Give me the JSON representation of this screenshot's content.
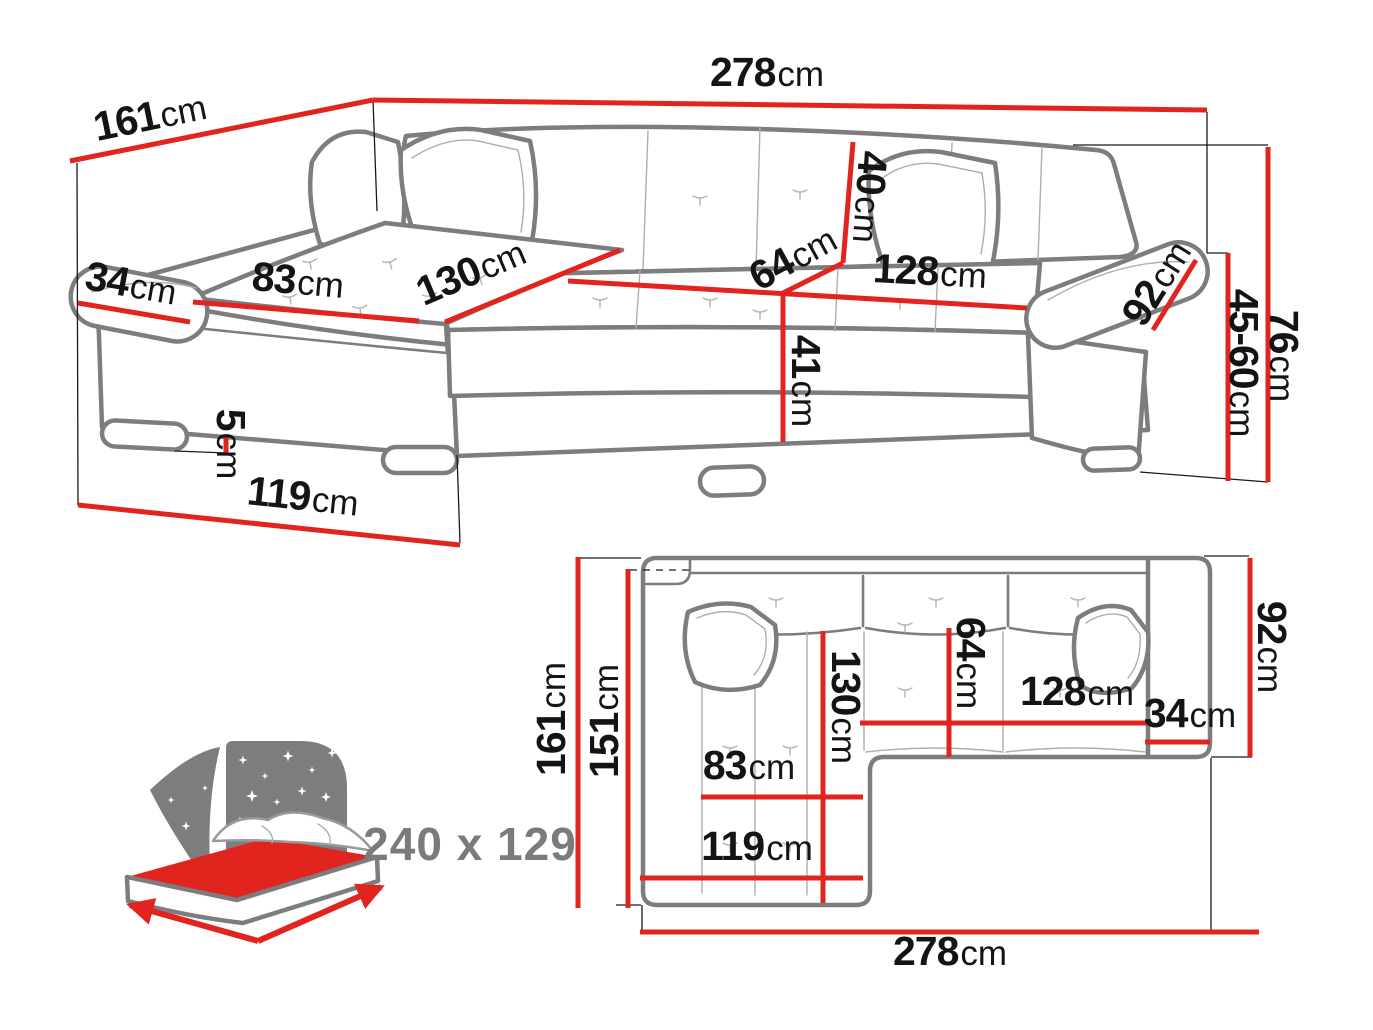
{
  "palette": {
    "red": "#e2241f",
    "sketch_gray": "#7d7d7f",
    "seam_gray": "#aeaeb0",
    "text_black": "#141414",
    "muted_gray": "#7b7b7d",
    "background": "#ffffff"
  },
  "perspective_view": {
    "dimensions": {
      "back_width": {
        "value": "278",
        "unit": "cm"
      },
      "side_depth": {
        "value": "161",
        "unit": "cm"
      },
      "left_arm_width": {
        "value": "34",
        "unit": "cm"
      },
      "chaise_cushion_width": {
        "value": "83",
        "unit": "cm"
      },
      "chaise_cushion_length": {
        "value": "130",
        "unit": "cm"
      },
      "seat_depth": {
        "value": "64",
        "unit": "cm"
      },
      "backrest_height": {
        "value": "40",
        "unit": "cm"
      },
      "seat_front_width": {
        "value": "128",
        "unit": "cm"
      },
      "right_arm_length": {
        "value": "92",
        "unit": "cm"
      },
      "overall_height": {
        "value": "76",
        "unit": "cm"
      },
      "armrest_height": {
        "value": "45-60",
        "unit": "cm"
      },
      "seat_height": {
        "value": "41",
        "unit": "cm"
      },
      "leg_height": {
        "value": "5",
        "unit": "cm"
      },
      "chaise_front_depth": {
        "value": "119",
        "unit": "cm"
      }
    }
  },
  "top_view": {
    "dimensions": {
      "total_depth": {
        "value": "161",
        "unit": "cm"
      },
      "inner_depth": {
        "value": "151",
        "unit": "cm"
      },
      "chaise_length": {
        "value": "130",
        "unit": "cm"
      },
      "seat_depth": {
        "value": "64",
        "unit": "cm"
      },
      "seat_width": {
        "value": "128",
        "unit": "cm"
      },
      "arm_width": {
        "value": "34",
        "unit": "cm"
      },
      "right_side_depth": {
        "value": "92",
        "unit": "cm"
      },
      "chaise_width": {
        "value": "83",
        "unit": "cm"
      },
      "chaise_outer_width": {
        "value": "119",
        "unit": "cm"
      },
      "total_width": {
        "value": "278",
        "unit": "cm"
      }
    }
  },
  "sleeping_icon": {
    "label": "240 x 129"
  }
}
